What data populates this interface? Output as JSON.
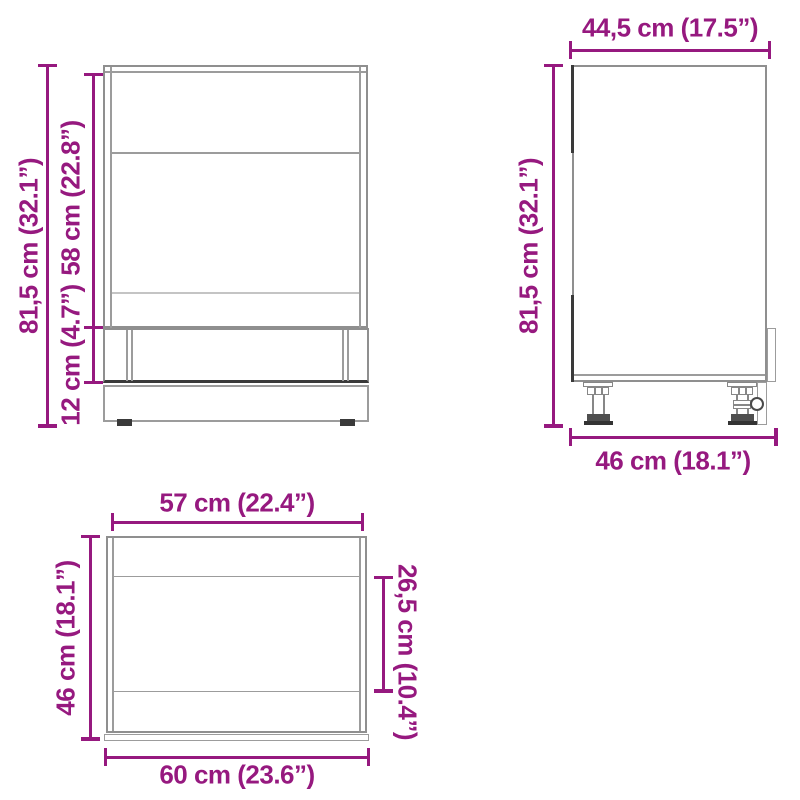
{
  "colors": {
    "dimension_accent": "#96197f",
    "outline_gray": "#8f8f8f",
    "outline_light": "#c4c4c4",
    "outline_dark": "#3a3a3a",
    "background": "#ffffff"
  },
  "views": {
    "front": {
      "label_total_height": "81,5 cm (32.1”)",
      "label_upper_height": "58 cm (22.8”)",
      "label_plinth_height": "12 cm (4.7”)"
    },
    "side": {
      "label_top_depth": "44,5 cm (17.5”)",
      "label_height": "81,5 cm (32.1”)",
      "label_bottom_depth": "46 cm (18.1”)"
    },
    "top": {
      "label_inner_width": "57 cm (22.4”)",
      "label_depth": "46 cm (18.1”)",
      "label_partial_depth": "26,5 cm (10.4”)",
      "label_outer_width": "60 cm (23.6”)"
    }
  }
}
